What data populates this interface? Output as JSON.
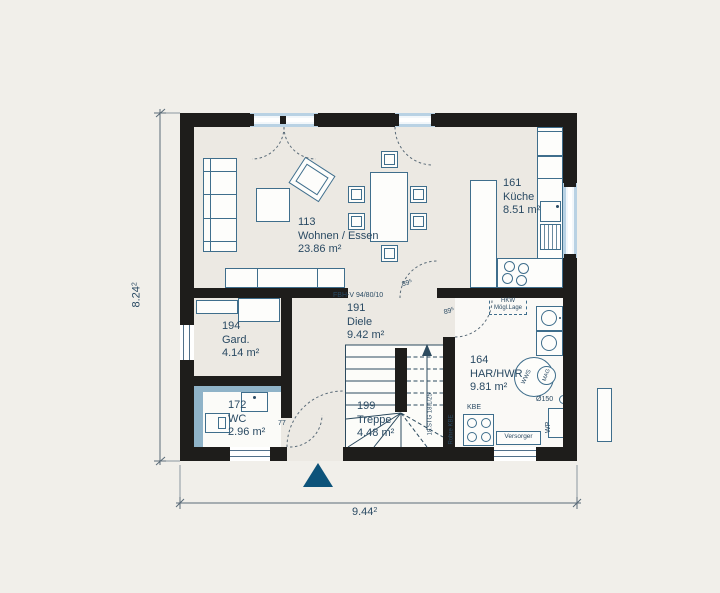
{
  "plan": {
    "rooms": [
      {
        "number": "113",
        "name": "Wohnen / Essen",
        "area": "23.86 m²"
      },
      {
        "number": "161",
        "name": "Küche",
        "area": "8.51 m²"
      },
      {
        "number": "194",
        "name": "Gard.",
        "area": "4.14 m²"
      },
      {
        "number": "191",
        "name": "Diele",
        "area": "9.42 m²"
      },
      {
        "number": "164",
        "name": "HAR/HWR",
        "area": "9.81 m²"
      },
      {
        "number": "172",
        "name": "WC",
        "area": "2.96 m²"
      },
      {
        "number": "199",
        "name": "Treppe",
        "area": "4.48 m²"
      }
    ],
    "notes": {
      "floor_heating": "FBH-V 94/80/10",
      "door_width_base": "89",
      "door_width_sup": "5",
      "wc_door_width": "77",
      "stair_note": "18.STG 18.1/25"
    },
    "equipment": {
      "hkw_line1": "HKW",
      "hkw_line2": "Mögl.Lage",
      "wws": "WWS",
      "mag": "MAG",
      "vent": "Ø150",
      "wp": "WP",
      "kbe": "KBE",
      "rohre_kbe": "Rohre KBE",
      "versorger": "Versorger"
    },
    "dimensions": {
      "height_base": "8.24",
      "height_sup": "2",
      "width_base": "9.44",
      "width_sup": "2"
    },
    "colors": {
      "wall": "#1e1d1b",
      "line": "#3f6e8c",
      "text": "#2a4a63",
      "accent_triangle": "#0d537a",
      "tile": "#8fb3c8",
      "window_blue": "#b9d2e4",
      "background": "#f1efea"
    }
  }
}
